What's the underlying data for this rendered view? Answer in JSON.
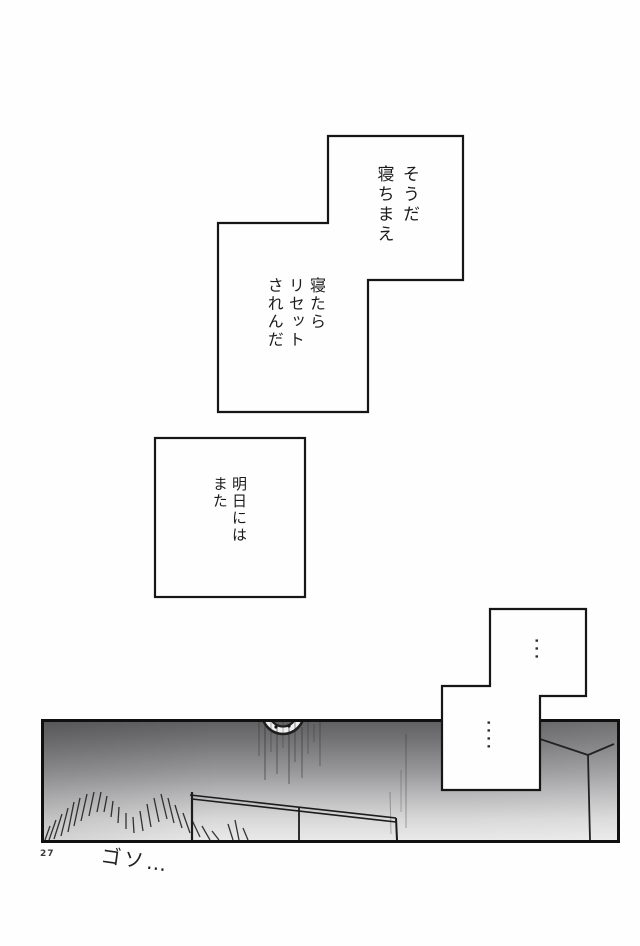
{
  "page": {
    "number": "27",
    "paper_color": "#fefefe",
    "ink_color": "#161616"
  },
  "speech": {
    "bubble1": {
      "text": "そうだ\n寝ちまえ"
    },
    "bubble2": {
      "text": "寝たら\nリセット\nされんだ"
    },
    "bubble3": {
      "text": "明日には\nまた"
    },
    "bubble4_top": {
      "text": "..."
    },
    "bubble4_bottom": {
      "text": "...."
    }
  },
  "sfx": {
    "text": "ゴソ…"
  },
  "panel": {
    "gradient_top": "#616163",
    "gradient_bottom": "#e9e9e9",
    "line_color": "#1c1c1c"
  }
}
